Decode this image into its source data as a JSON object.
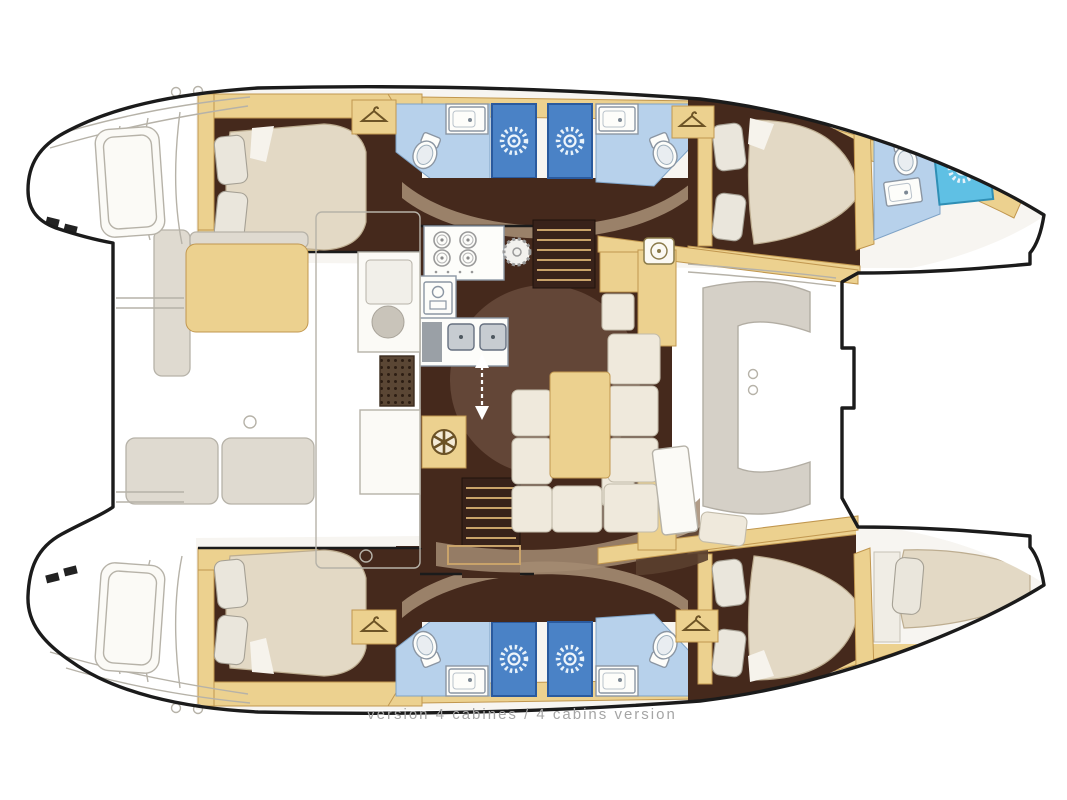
{
  "caption": {
    "text": "version 4 cabines / 4 cabins version"
  },
  "palette": {
    "outline": "#1b1b1b",
    "sketch": "#b6b2a8",
    "tan": "#ecd18f",
    "tan_dark": "#c1974f",
    "brown_dark": "#45291c",
    "brown_mid": "#7c5f4e",
    "brown_light": "#a38b72",
    "cream": "#efe9dc",
    "cream_edge": "#c2bbaa",
    "mattress": "#e3d9c5",
    "mattress_edge": "#bdad90",
    "pillow": "#eae6dc",
    "pillow_edge": "#a5a094",
    "bath_floor": "#b7d1eb",
    "shower_blue": "#4a82c6",
    "shower_edge": "#2a5a9e",
    "shower_cyan": "#5fc0e4",
    "fixture": "#fdfdfa",
    "fixture_edge": "#8b96a3",
    "stair": "#38221a",
    "tread": "#c9a36a",
    "caption": "#a5a5a5"
  },
  "icons": {
    "shower-sun-icon": "white sunburst on blue shower tile",
    "toilet-icon": "oval bowl with tank",
    "sink-icon": "rectangular basin with drain dot",
    "stove-burners-icon": "four gas burners",
    "round-hob-icon": "dashed circular hob",
    "oven-icon": "small oven with window",
    "double-sink-icon": "two square galley sinks",
    "vent-wheel-icon": "spoked wheel vent",
    "wardrobe-hanger-icon": "clothes hanger",
    "companionway-arrow-icon": "white dashed double arrow",
    "nav-instrument-icon": "square instrument with dial",
    "deck-grate-icon": "dotted grate",
    "cleat-icon": "small black deck cleat"
  },
  "areas": [
    "port-aft-cabin",
    "port-aft-bathroom",
    "port-forward-bathroom",
    "port-forward-cabin",
    "bow-bathroom",
    "starboard-aft-cabin",
    "starboard-aft-bathroom",
    "starboard-forward-bathroom",
    "starboard-forward-cabin",
    "bow-berth",
    "galley",
    "saloon",
    "nav-seat",
    "aft-cockpit",
    "forward-cockpit",
    "port-stairs",
    "starboard-stairs",
    "port-transom-steps",
    "starboard-transom-steps"
  ]
}
